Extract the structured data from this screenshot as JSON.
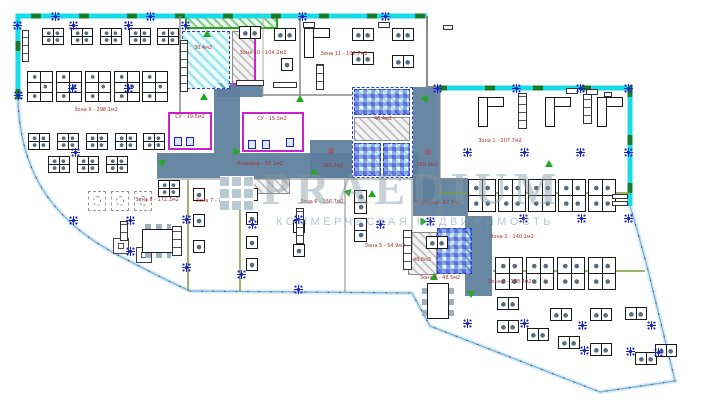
{
  "watermark": {
    "brand": "PRAEDIUM",
    "tagline": "КОММЕРЧЕСКАЯ НЕДВИЖИМОСТЬ"
  },
  "colors": {
    "wall_cyan": "#18dbe8",
    "wall_dash_green": "#157a2b",
    "corridor_fill": "#5c7e9c",
    "zone_label_red": "#a33333",
    "annotation_red": "#e03030",
    "grid_marker_blue": "#1822cc",
    "door_green": "#22aa22",
    "boundary_blue": "#79aed6",
    "wc_magenta": "#cc22cc",
    "tech_room_blue": "#2b3fd0"
  },
  "area_labels": [
    {
      "text": "Зона 9 - 298.1м2",
      "x": 96,
      "y": 108
    },
    {
      "text": "Зона 10 - 104.2м2",
      "x": 263,
      "y": 51
    },
    {
      "text": "Зона 11 - 106.7м2",
      "x": 344,
      "y": 52
    },
    {
      "text": "Зона 1 - 207.7м2",
      "x": 500,
      "y": 139
    },
    {
      "text": "Зона 2 - 140.1м2",
      "x": 512,
      "y": 235
    },
    {
      "text": "Зона 3 - 178.4м2",
      "x": 510,
      "y": 280
    },
    {
      "text": "Зона 4 - 48.5м2",
      "x": 440,
      "y": 276
    },
    {
      "text": "Зона 5 - 54.9м2",
      "x": 385,
      "y": 244
    },
    {
      "text": "Зона 6 - 156.7м2",
      "x": 322,
      "y": 200
    },
    {
      "text": "Зона 7 - 77.9м2",
      "x": 216,
      "y": 199
    },
    {
      "text": "Зона 8 - 172.3м2",
      "x": 157,
      "y": 198
    },
    {
      "text": "Коридор - 97.1м2",
      "x": 260,
      "y": 162
    },
    {
      "text": "Коридор - 67.1м2",
      "x": 438,
      "y": 201
    },
    {
      "text": "30.4м2",
      "x": 203,
      "y": 46
    },
    {
      "text": "46.4м2",
      "x": 383,
      "y": 117
    },
    {
      "text": "СУ - 19.5м2",
      "x": 190,
      "y": 115
    },
    {
      "text": "СУ - 15.3м2",
      "x": 272,
      "y": 117
    },
    {
      "text": "48.6м2",
      "x": 422,
      "y": 258
    },
    {
      "text": "②",
      "x": 331,
      "y": 148,
      "cls": "big"
    },
    {
      "text": "169.7м2",
      "x": 333,
      "y": 164
    },
    {
      "text": "①",
      "x": 428,
      "y": 149,
      "cls": "big"
    },
    {
      "text": "169.3м2",
      "x": 427,
      "y": 163
    }
  ],
  "symbols": [
    {
      "t": "pod4",
      "x": 42,
      "y": 28
    },
    {
      "t": "pod4",
      "x": 71,
      "y": 28
    },
    {
      "t": "pod4",
      "x": 100,
      "y": 28
    },
    {
      "t": "pod4",
      "x": 129,
      "y": 28
    },
    {
      "t": "pod4",
      "x": 157,
      "y": 28
    },
    {
      "t": "pod6",
      "x": 27,
      "y": 71
    },
    {
      "t": "pod6",
      "x": 56,
      "y": 71
    },
    {
      "t": "pod6",
      "x": 85,
      "y": 71
    },
    {
      "t": "pod6",
      "x": 114,
      "y": 71
    },
    {
      "t": "pod6",
      "x": 142,
      "y": 71
    },
    {
      "t": "pod4",
      "x": 28,
      "y": 133
    },
    {
      "t": "pod4",
      "x": 57,
      "y": 133
    },
    {
      "t": "pod4",
      "x": 86,
      "y": 133
    },
    {
      "t": "pod4",
      "x": 115,
      "y": 133
    },
    {
      "t": "pod4",
      "x": 143,
      "y": 133
    },
    {
      "t": "pod4",
      "x": 48,
      "y": 156
    },
    {
      "t": "pod4",
      "x": 77,
      "y": 156
    },
    {
      "t": "pod4",
      "x": 106,
      "y": 156
    },
    {
      "t": "pod4",
      "x": 158,
      "y": 180
    },
    {
      "t": "pairh",
      "x": 239,
      "y": 26
    },
    {
      "t": "pairh",
      "x": 274,
      "y": 28
    },
    {
      "t": "single",
      "x": 281,
      "y": 58
    },
    {
      "t": "ldesk",
      "x": 304,
      "y": 28
    },
    {
      "t": "pairh",
      "x": 352,
      "y": 28
    },
    {
      "t": "pairh",
      "x": 352,
      "y": 52
    },
    {
      "t": "pairh",
      "x": 392,
      "y": 28
    },
    {
      "t": "pairh",
      "x": 392,
      "y": 55
    },
    {
      "t": "ldesk",
      "x": 478,
      "y": 97
    },
    {
      "t": "ldesk",
      "x": 545,
      "y": 97
    },
    {
      "t": "ldesk",
      "x": 597,
      "y": 97
    },
    {
      "t": "pod4b",
      "x": 468,
      "y": 179
    },
    {
      "t": "pod4b",
      "x": 498,
      "y": 179
    },
    {
      "t": "pod4b",
      "x": 528,
      "y": 179
    },
    {
      "t": "pod4b",
      "x": 558,
      "y": 179
    },
    {
      "t": "pod4b",
      "x": 588,
      "y": 179
    },
    {
      "t": "pod4b",
      "x": 495,
      "y": 257
    },
    {
      "t": "pod4b",
      "x": 526,
      "y": 257
    },
    {
      "t": "pod4b",
      "x": 557,
      "y": 257
    },
    {
      "t": "pod4b",
      "x": 588,
      "y": 257
    },
    {
      "t": "pairh",
      "x": 426,
      "y": 236
    },
    {
      "t": "pairh",
      "x": 497,
      "y": 297
    },
    {
      "t": "pairh",
      "x": 497,
      "y": 320
    },
    {
      "t": "pairh",
      "x": 527,
      "y": 328
    },
    {
      "t": "pairh",
      "x": 550,
      "y": 308
    },
    {
      "t": "pairh",
      "x": 590,
      "y": 308
    },
    {
      "t": "pairh",
      "x": 625,
      "y": 307
    },
    {
      "t": "pairh",
      "x": 558,
      "y": 336
    },
    {
      "t": "pairh",
      "x": 590,
      "y": 343
    },
    {
      "t": "pairh",
      "x": 635,
      "y": 352
    },
    {
      "t": "pairh",
      "x": 655,
      "y": 344
    },
    {
      "t": "pairv",
      "x": 354,
      "y": 190
    },
    {
      "t": "pairv",
      "x": 354,
      "y": 218
    },
    {
      "t": "single",
      "x": 193,
      "y": 188
    },
    {
      "t": "single",
      "x": 193,
      "y": 214
    },
    {
      "t": "single",
      "x": 193,
      "y": 240
    },
    {
      "t": "single",
      "x": 246,
      "y": 188
    },
    {
      "t": "single",
      "x": 246,
      "y": 212
    },
    {
      "t": "single",
      "x": 246,
      "y": 236
    },
    {
      "t": "single",
      "x": 246,
      "y": 258
    },
    {
      "t": "single",
      "x": 293,
      "y": 220
    },
    {
      "t": "single",
      "x": 293,
      "y": 244
    },
    {
      "t": "dtable",
      "x": 88,
      "y": 191
    },
    {
      "t": "dtable",
      "x": 111,
      "y": 191
    },
    {
      "t": "dtable",
      "x": 134,
      "y": 191
    },
    {
      "t": "stable",
      "x": 113,
      "y": 238
    },
    {
      "t": "stable",
      "x": 136,
      "y": 247
    },
    {
      "t": "conf",
      "x": 142,
      "y": 229
    },
    {
      "t": "confv",
      "x": 427,
      "y": 283
    },
    {
      "t": "cab",
      "x": 22,
      "y": 30,
      "w": 7,
      "h": 32
    },
    {
      "t": "cab",
      "x": 180,
      "y": 40,
      "w": 8,
      "h": 52
    },
    {
      "t": "cab",
      "x": 120,
      "y": 221,
      "w": 8,
      "h": 20
    },
    {
      "t": "cab",
      "x": 172,
      "y": 226,
      "w": 10,
      "h": 30
    },
    {
      "t": "cab",
      "x": 296,
      "y": 208,
      "w": 8,
      "h": 36
    },
    {
      "t": "cab",
      "x": 403,
      "y": 230,
      "w": 9,
      "h": 40
    },
    {
      "t": "cab",
      "x": 316,
      "y": 64,
      "w": 8,
      "h": 26
    },
    {
      "t": "cab",
      "x": 518,
      "y": 93,
      "w": 9,
      "h": 36
    },
    {
      "t": "cab",
      "x": 583,
      "y": 94,
      "w": 9,
      "h": 30
    },
    {
      "t": "cab",
      "x": 236,
      "y": 80,
      "w": 28,
      "h": 6
    },
    {
      "t": "cab",
      "x": 273,
      "y": 82,
      "w": 24,
      "h": 6
    },
    {
      "t": "cab",
      "x": 612,
      "y": 194,
      "w": 16,
      "h": 5
    },
    {
      "t": "cab",
      "x": 612,
      "y": 201,
      "w": 16,
      "h": 5
    },
    {
      "t": "cab",
      "x": 378,
      "y": 22,
      "w": 12,
      "h": 6
    },
    {
      "t": "cab",
      "x": 443,
      "y": 25,
      "w": 10,
      "h": 5
    },
    {
      "t": "cab",
      "x": 566,
      "y": 88,
      "w": 12,
      "h": 6
    },
    {
      "t": "cab",
      "x": 586,
      "y": 89,
      "w": 12,
      "h": 6
    },
    {
      "t": "cab",
      "x": 604,
      "y": 92,
      "w": 8,
      "h": 5
    },
    {
      "t": "cab",
      "x": 303,
      "y": 22,
      "w": 12,
      "h": 6
    },
    {
      "t": "fix",
      "x": 174,
      "y": 137
    },
    {
      "t": "fix",
      "x": 186,
      "y": 137
    },
    {
      "t": "fix",
      "x": 248,
      "y": 140
    },
    {
      "t": "fix",
      "x": 262,
      "y": 140
    },
    {
      "t": "fix",
      "x": 286,
      "y": 138
    }
  ],
  "markers": [
    [
      55,
      16
    ],
    [
      150,
      16
    ],
    [
      302,
      16
    ],
    [
      385,
      16
    ],
    [
      17,
      25
    ],
    [
      73,
      25
    ],
    [
      128,
      25
    ],
    [
      185,
      25
    ],
    [
      72,
      88
    ],
    [
      128,
      88
    ],
    [
      18,
      95
    ],
    [
      75,
      152
    ],
    [
      437,
      88
    ],
    [
      516,
      88
    ],
    [
      580,
      88
    ],
    [
      628,
      88
    ],
    [
      467,
      152
    ],
    [
      524,
      152
    ],
    [
      580,
      152
    ],
    [
      628,
      152
    ],
    [
      252,
      224
    ],
    [
      380,
      224
    ],
    [
      430,
      221
    ],
    [
      73,
      220
    ],
    [
      130,
      220
    ],
    [
      130,
      251
    ],
    [
      186,
      219
    ],
    [
      186,
      267
    ],
    [
      241,
      274
    ],
    [
      298,
      219
    ],
    [
      298,
      289
    ],
    [
      523,
      218
    ],
    [
      581,
      218
    ],
    [
      628,
      218
    ],
    [
      467,
      323
    ],
    [
      524,
      323
    ],
    [
      582,
      325
    ],
    [
      651,
      325
    ],
    [
      584,
      350
    ],
    [
      630,
      351
    ],
    [
      658,
      352
    ]
  ],
  "door_triangles": [
    [
      200,
      93,
      0
    ],
    [
      233,
      148,
      90
    ],
    [
      158,
      160,
      180
    ],
    [
      310,
      168,
      0
    ],
    [
      345,
      188,
      45
    ],
    [
      368,
      190,
      0
    ],
    [
      420,
      218,
      90
    ],
    [
      430,
      273,
      0
    ],
    [
      467,
      291,
      180
    ],
    [
      203,
      30,
      0
    ],
    [
      296,
      95,
      0
    ],
    [
      420,
      95,
      270
    ],
    [
      545,
      160,
      0
    ]
  ]
}
